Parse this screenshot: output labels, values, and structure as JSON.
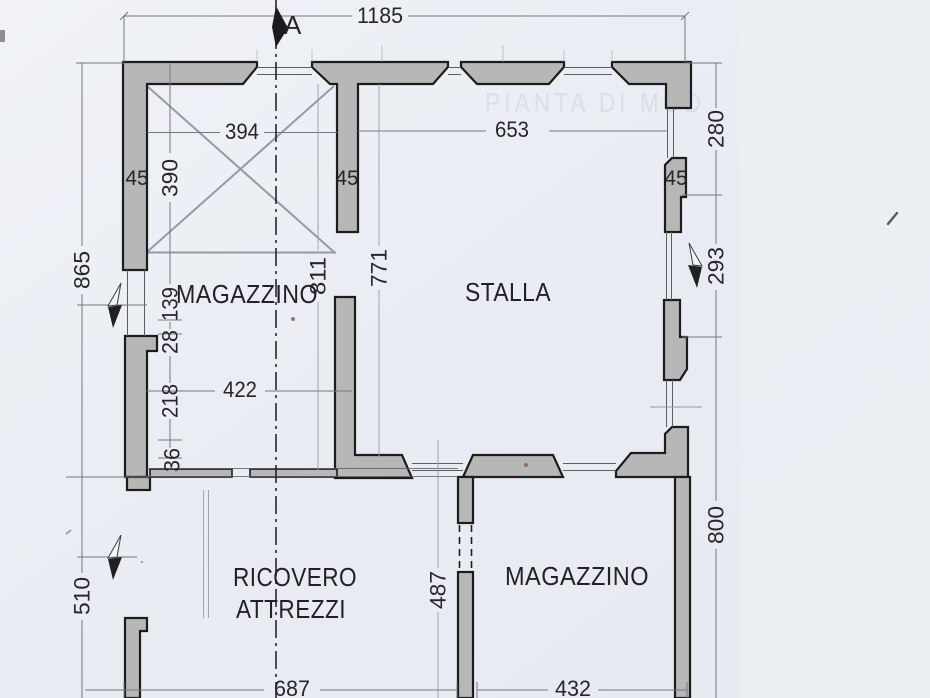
{
  "section_label": "A",
  "watermark": "PIANTA DI MOD",
  "rooms": {
    "magazzino_top": "MAGAZZINO",
    "stalla": "STALLA",
    "ricovero_line1": "RICOVERO",
    "ricovero_line2": "ATTREZZI",
    "magazzino_bottom": "MAGAZZINO"
  },
  "dims": {
    "total_width": "1185",
    "room_top_width": "394",
    "room_top_height": "390",
    "stalla_width": "653",
    "wall_thickness_left": "45",
    "wall_thickness_mid": "45",
    "wall_thickness_right": "45",
    "left_upper": "865",
    "left_lower": "510",
    "right_upper": "280",
    "right_opening": "293",
    "right_lower": "800",
    "magazzino_inner_height": "811",
    "stalla_inner_height": "771",
    "seg_139": "139",
    "seg_28": "28",
    "seg_218": "218",
    "seg_36": "36",
    "magazzino_inner_width": "422",
    "ricovero_inner_height": "487",
    "bottom_left_width": "687",
    "bottom_right_width": "432"
  },
  "colors": {
    "paper": "#eceff4",
    "wall_fill": "#b7b7b7",
    "outline": "#1c1c1f",
    "dim_line": "#74777d",
    "pencil": "#959ba5",
    "text": "#26262a",
    "watermark": "#7e95b8"
  }
}
